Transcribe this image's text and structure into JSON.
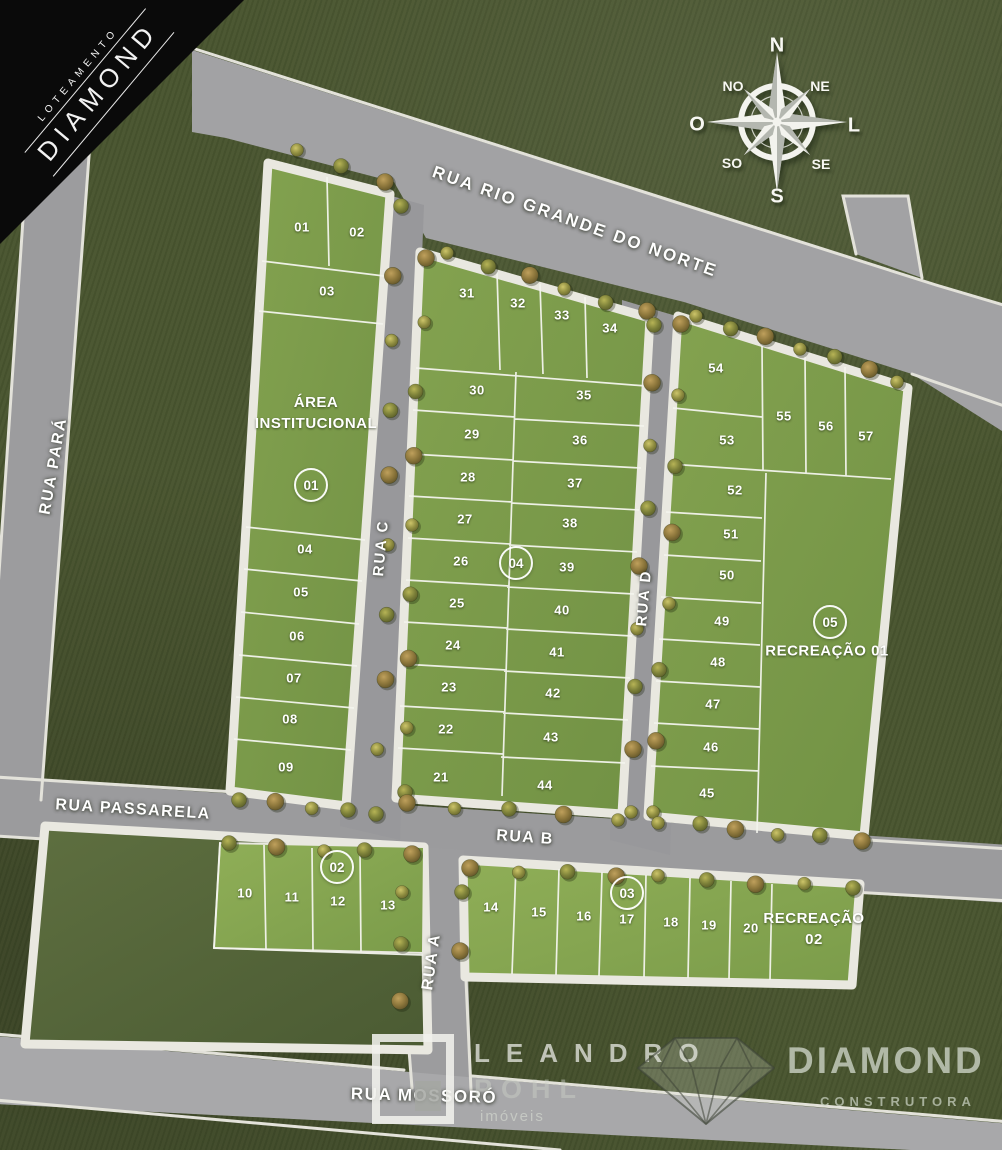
{
  "banner": {
    "subtitle": "LOTEAMENTO",
    "title": "DIAMOND"
  },
  "compass": {
    "n": "N",
    "ne": "NE",
    "e": "L",
    "se": "SE",
    "s": "S",
    "sw": "SO",
    "w": "O",
    "nw": "NO"
  },
  "streets": {
    "rio_grande": {
      "label": "RUA RIO GRANDE DO NORTE"
    },
    "para": {
      "label": "RUA PARÁ"
    },
    "rua_c": {
      "label": "RUA C"
    },
    "rua_d": {
      "label": "RUA D"
    },
    "passarela": {
      "label": "RUA PASSARELA"
    },
    "rua_b": {
      "label": "RUA B"
    },
    "rua_a": {
      "label": "RUA A"
    },
    "mossoro": {
      "label": "RUA MOSSORÓ"
    }
  },
  "quadras": [
    {
      "badge": "01",
      "x": 311,
      "y": 485
    },
    {
      "badge": "02",
      "x": 337,
      "y": 867
    },
    {
      "badge": "03",
      "x": 627,
      "y": 893
    },
    {
      "badge": "04",
      "x": 516,
      "y": 563
    },
    {
      "badge": "05",
      "x": 830,
      "y": 622
    }
  ],
  "areas": [
    {
      "lines": [
        "ÁREA",
        "INSTITUCIONAL"
      ],
      "x": 316,
      "y": 413
    },
    {
      "lines": [
        "RECREAÇÃO 01"
      ],
      "x": 827,
      "y": 651
    },
    {
      "lines": [
        "RECREAÇÃO",
        "02"
      ],
      "x": 814,
      "y": 929
    }
  ],
  "lots": [
    {
      "n": "01",
      "x": 302,
      "y": 227
    },
    {
      "n": "02",
      "x": 357,
      "y": 232
    },
    {
      "n": "03",
      "x": 327,
      "y": 291
    },
    {
      "n": "04",
      "x": 305,
      "y": 549
    },
    {
      "n": "05",
      "x": 301,
      "y": 592
    },
    {
      "n": "06",
      "x": 297,
      "y": 636
    },
    {
      "n": "07",
      "x": 294,
      "y": 678
    },
    {
      "n": "08",
      "x": 290,
      "y": 719
    },
    {
      "n": "09",
      "x": 286,
      "y": 767
    },
    {
      "n": "10",
      "x": 245,
      "y": 893
    },
    {
      "n": "11",
      "x": 292,
      "y": 897
    },
    {
      "n": "12",
      "x": 338,
      "y": 901
    },
    {
      "n": "13",
      "x": 388,
      "y": 905
    },
    {
      "n": "14",
      "x": 491,
      "y": 907
    },
    {
      "n": "15",
      "x": 539,
      "y": 912
    },
    {
      "n": "16",
      "x": 584,
      "y": 916
    },
    {
      "n": "17",
      "x": 627,
      "y": 919
    },
    {
      "n": "18",
      "x": 671,
      "y": 922
    },
    {
      "n": "19",
      "x": 709,
      "y": 925
    },
    {
      "n": "20",
      "x": 751,
      "y": 928
    },
    {
      "n": "21",
      "x": 441,
      "y": 777
    },
    {
      "n": "22",
      "x": 446,
      "y": 729
    },
    {
      "n": "23",
      "x": 449,
      "y": 687
    },
    {
      "n": "24",
      "x": 453,
      "y": 645
    },
    {
      "n": "25",
      "x": 457,
      "y": 603
    },
    {
      "n": "26",
      "x": 461,
      "y": 561
    },
    {
      "n": "27",
      "x": 465,
      "y": 519
    },
    {
      "n": "28",
      "x": 468,
      "y": 477
    },
    {
      "n": "29",
      "x": 472,
      "y": 434
    },
    {
      "n": "30",
      "x": 477,
      "y": 390
    },
    {
      "n": "31",
      "x": 467,
      "y": 293
    },
    {
      "n": "32",
      "x": 518,
      "y": 303
    },
    {
      "n": "33",
      "x": 562,
      "y": 315
    },
    {
      "n": "34",
      "x": 610,
      "y": 328
    },
    {
      "n": "35",
      "x": 584,
      "y": 395
    },
    {
      "n": "36",
      "x": 580,
      "y": 440
    },
    {
      "n": "37",
      "x": 575,
      "y": 483
    },
    {
      "n": "38",
      "x": 570,
      "y": 523
    },
    {
      "n": "39",
      "x": 567,
      "y": 567
    },
    {
      "n": "40",
      "x": 562,
      "y": 610
    },
    {
      "n": "41",
      "x": 557,
      "y": 652
    },
    {
      "n": "42",
      "x": 553,
      "y": 693
    },
    {
      "n": "43",
      "x": 551,
      "y": 737
    },
    {
      "n": "44",
      "x": 545,
      "y": 785
    },
    {
      "n": "45",
      "x": 707,
      "y": 793
    },
    {
      "n": "46",
      "x": 711,
      "y": 747
    },
    {
      "n": "47",
      "x": 713,
      "y": 704
    },
    {
      "n": "48",
      "x": 718,
      "y": 662
    },
    {
      "n": "49",
      "x": 722,
      "y": 621
    },
    {
      "n": "50",
      "x": 727,
      "y": 575
    },
    {
      "n": "51",
      "x": 731,
      "y": 534
    },
    {
      "n": "52",
      "x": 735,
      "y": 490
    },
    {
      "n": "53",
      "x": 727,
      "y": 440
    },
    {
      "n": "54",
      "x": 716,
      "y": 368
    },
    {
      "n": "55",
      "x": 784,
      "y": 416
    },
    {
      "n": "56",
      "x": 826,
      "y": 426
    },
    {
      "n": "57",
      "x": 866,
      "y": 436
    }
  ],
  "watermarks": {
    "realtor": {
      "line1": "LEANDRO",
      "line2": "POHL",
      "line3": "imóveis"
    },
    "builder": {
      "name": "DIAMOND",
      "tagline": "CONSTRUTORA"
    }
  }
}
